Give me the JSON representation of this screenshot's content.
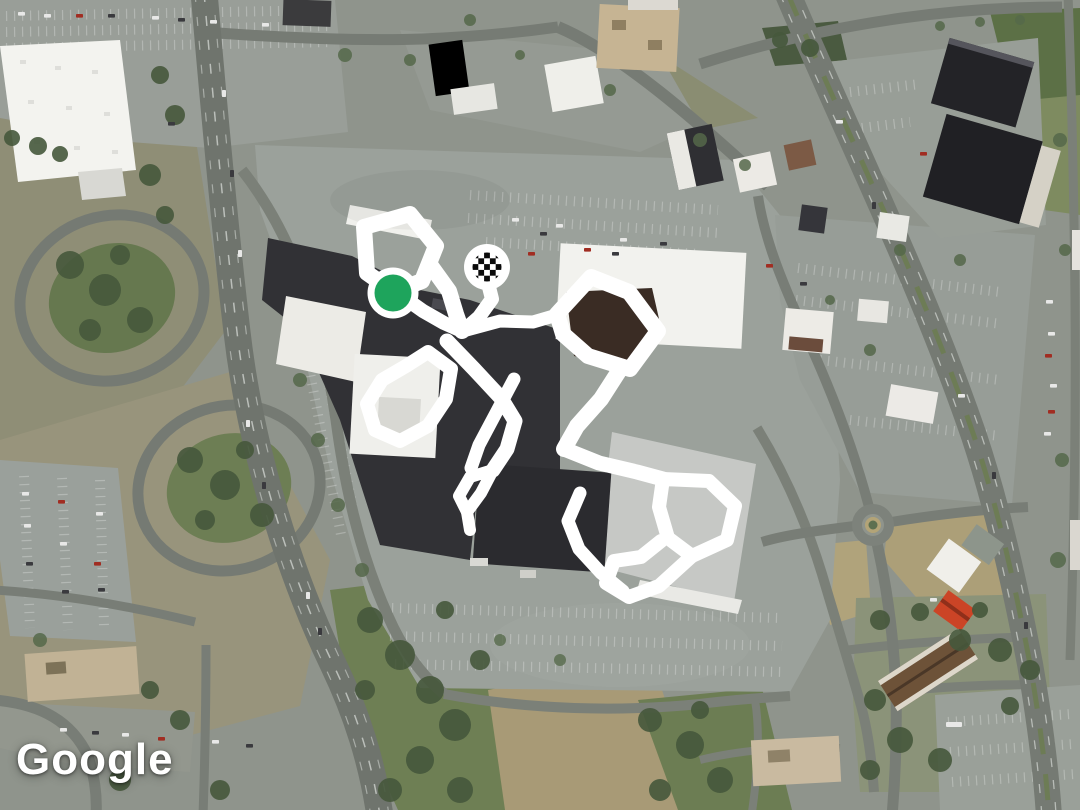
{
  "map": {
    "provider": "Google",
    "watermark_text": "Google",
    "imagery": "satellite",
    "route": {
      "stroke_color": "#ffffff",
      "segments": [
        {
          "closed": true,
          "width": 16,
          "points": [
            [
              364,
              227
            ],
            [
              410,
              214
            ],
            [
              436,
              246
            ],
            [
              422,
              281
            ],
            [
              394,
              292
            ],
            [
              367,
              273
            ]
          ]
        },
        {
          "closed": false,
          "width": 16,
          "points": [
            [
              431,
              266
            ],
            [
              449,
              291
            ],
            [
              456,
              314
            ],
            [
              462,
              331
            ]
          ]
        },
        {
          "closed": false,
          "width": 14,
          "points": [
            [
              399,
              294
            ],
            [
              423,
              311
            ],
            [
              444,
              323
            ],
            [
              462,
              331
            ]
          ]
        },
        {
          "closed": false,
          "width": 14,
          "points": [
            [
              487,
              279
            ],
            [
              492,
              299
            ],
            [
              479,
              317
            ],
            [
              463,
              331
            ]
          ]
        },
        {
          "closed": false,
          "width": 13,
          "points": [
            [
              463,
              331
            ],
            [
              500,
              321
            ],
            [
              533,
              322
            ],
            [
              557,
              315
            ]
          ]
        },
        {
          "closed": true,
          "width": 16,
          "points": [
            [
              557,
              314
            ],
            [
              591,
              277
            ],
            [
              629,
              292
            ],
            [
              658,
              331
            ],
            [
              630,
              369
            ],
            [
              588,
              356
            ],
            [
              563,
              334
            ]
          ]
        },
        {
          "closed": false,
          "width": 16,
          "points": [
            [
              619,
              371
            ],
            [
              601,
              399
            ],
            [
              577,
              426
            ],
            [
              564,
              449
            ]
          ]
        },
        {
          "closed": false,
          "width": 15,
          "points": [
            [
              564,
              449
            ],
            [
              599,
              463
            ],
            [
              637,
              472
            ],
            [
              663,
              479
            ]
          ]
        },
        {
          "closed": true,
          "width": 14,
          "points": [
            [
              663,
              479
            ],
            [
              709,
              481
            ],
            [
              735,
              506
            ],
            [
              727,
              540
            ],
            [
              692,
              556
            ],
            [
              668,
              538
            ],
            [
              659,
              507
            ]
          ]
        },
        {
          "closed": false,
          "width": 14,
          "points": [
            [
              692,
              556
            ],
            [
              659,
              586
            ],
            [
              629,
              597
            ],
            [
              606,
              583
            ],
            [
              614,
              561
            ],
            [
              641,
              557
            ],
            [
              661,
              541
            ]
          ]
        },
        {
          "closed": false,
          "width": 13,
          "points": [
            [
              580,
              493
            ],
            [
              568,
              521
            ],
            [
              579,
              549
            ],
            [
              601,
              573
            ],
            [
              623,
              591
            ]
          ]
        },
        {
          "closed": true,
          "width": 14,
          "points": [
            [
              428,
              352
            ],
            [
              451,
              369
            ],
            [
              446,
              399
            ],
            [
              428,
              426
            ],
            [
              400,
              441
            ],
            [
              375,
              430
            ],
            [
              367,
              404
            ],
            [
              382,
              380
            ],
            [
              406,
              366
            ]
          ]
        },
        {
          "closed": false,
          "width": 15,
          "points": [
            [
              447,
              341
            ],
            [
              474,
              369
            ],
            [
              501,
              398
            ],
            [
              515,
              421
            ],
            [
              507,
              449
            ],
            [
              493,
              470
            ]
          ]
        },
        {
          "closed": false,
          "width": 13,
          "points": [
            [
              514,
              379
            ],
            [
              496,
              413
            ],
            [
              479,
              445
            ],
            [
              471,
              468
            ]
          ]
        },
        {
          "closed": true,
          "width": 12,
          "points": [
            [
              493,
              470
            ],
            [
              481,
              493
            ],
            [
              467,
              512
            ],
            [
              459,
              496
            ],
            [
              470,
              477
            ]
          ]
        },
        {
          "closed": false,
          "width": 12,
          "points": [
            [
              467,
              512
            ],
            [
              470,
              530
            ]
          ]
        }
      ]
    },
    "markers": {
      "start": {
        "label": "route-start",
        "x": 393,
        "y": 293,
        "dot_color": "#1EA45C",
        "ring_color": "#FFFFFF",
        "dot_radius": 18.5,
        "ring_radius": 25.5
      },
      "finish": {
        "label": "route-finish",
        "x": 487,
        "y": 267,
        "ring_color": "#FFFFFF",
        "checker_colors": [
          "#0A0A0A",
          "#FFFFFF"
        ],
        "ring_radius": 23,
        "checker_radius": 14.5
      }
    }
  }
}
